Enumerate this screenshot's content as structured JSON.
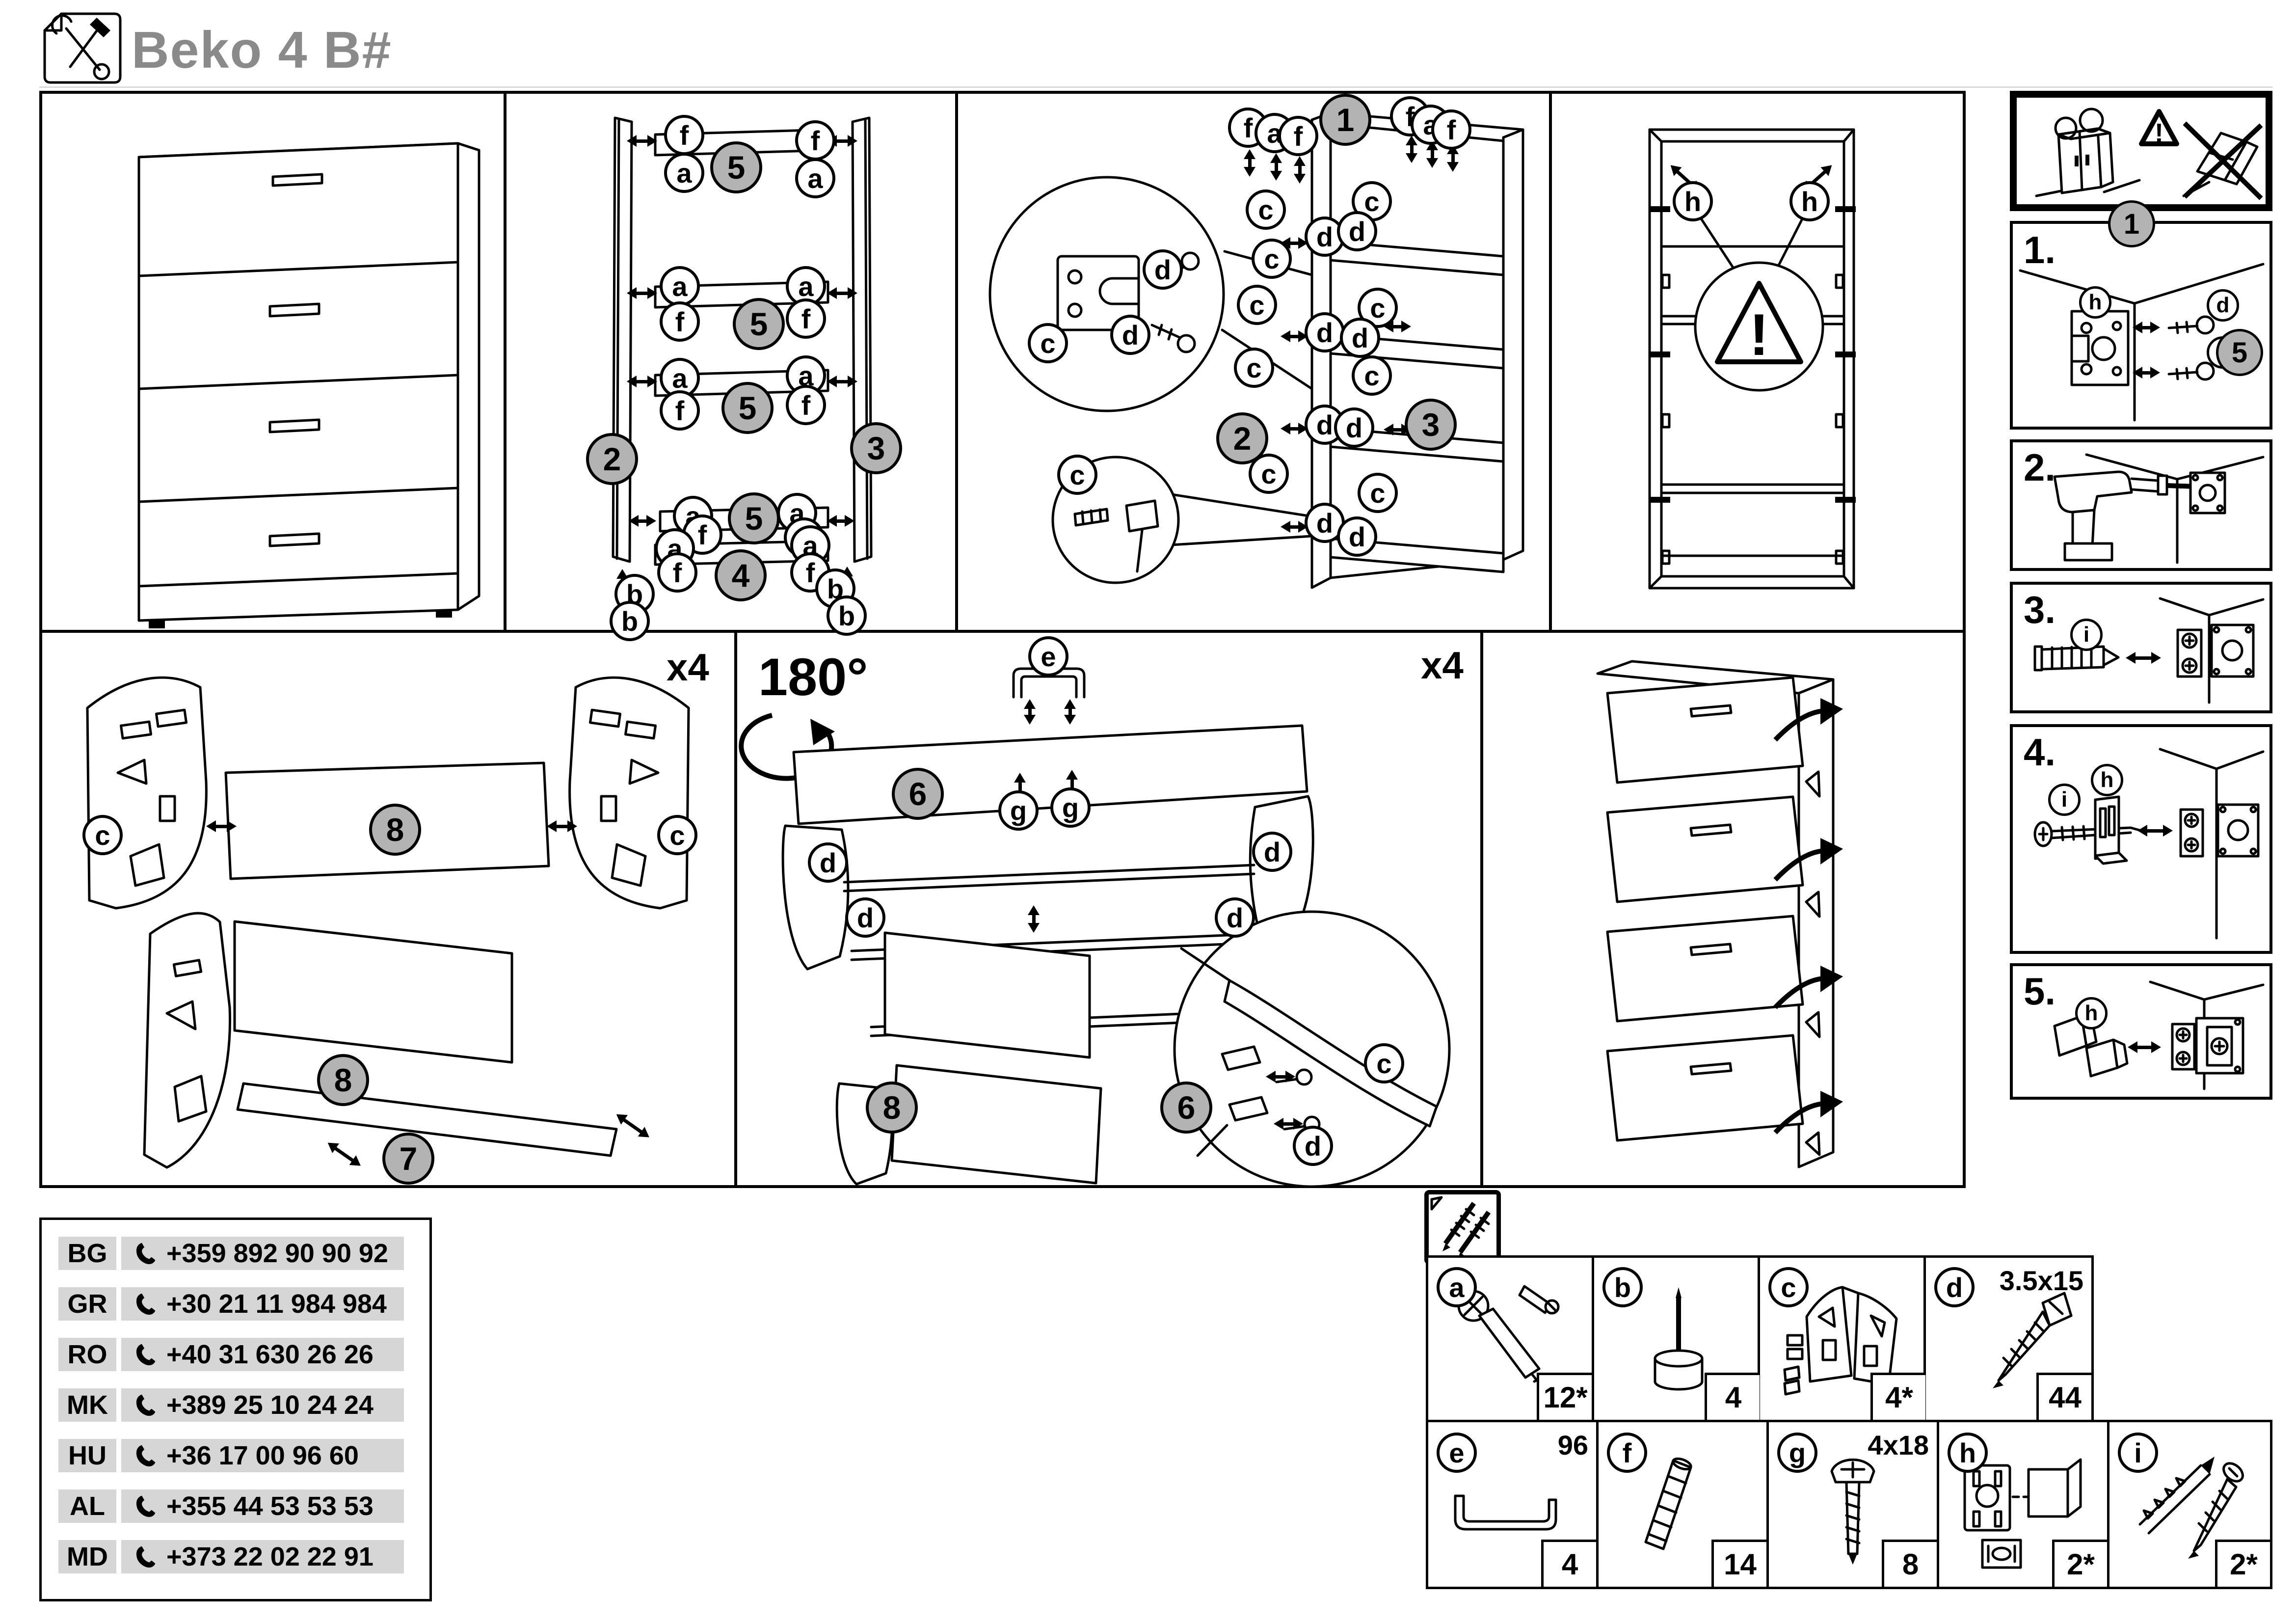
{
  "header": {
    "title": "Beko 4 B#"
  },
  "glyphs": {
    "a": "a",
    "b": "b",
    "c": "c",
    "d": "d",
    "e": "e",
    "f": "f",
    "g": "g",
    "h": "h",
    "i": "i",
    "n1": "1",
    "n2": "2",
    "n3": "3",
    "n4": "4",
    "n5": "5",
    "n6": "6",
    "n7": "7",
    "n8": "8",
    "warn": "!"
  },
  "annotations": {
    "x4": "x4",
    "deg": "180°"
  },
  "steps": {
    "s1": "1.",
    "s2": "2.",
    "s3": "3.",
    "s4": "4.",
    "s5": "5."
  },
  "parts": {
    "a": {
      "label": "a",
      "qty": "12*"
    },
    "b": {
      "label": "b",
      "qty": "4"
    },
    "c": {
      "label": "c",
      "qty": "4*"
    },
    "d": {
      "label": "d",
      "qty": "44",
      "size": "3.5x15"
    },
    "e": {
      "label": "e",
      "qty": "4",
      "size": "96"
    },
    "f": {
      "label": "f",
      "qty": "14"
    },
    "g": {
      "label": "g",
      "qty": "8",
      "size": "4x18"
    },
    "h": {
      "label": "h",
      "qty": "2*"
    },
    "i": {
      "label": "i",
      "qty": "2*"
    }
  },
  "hotline": {
    "rows": [
      {
        "code": "BG",
        "phone": "+359 892 90 90 92"
      },
      {
        "code": "GR",
        "phone": "+30 21 11 984 984"
      },
      {
        "code": "RO",
        "phone": "+40 31 630 26 26"
      },
      {
        "code": "MK",
        "phone": "+389 25 10 24 24"
      },
      {
        "code": "HU",
        "phone": "+36 17 00 96 60"
      },
      {
        "code": "AL",
        "phone": "+355 44 53 53 53"
      },
      {
        "code": "MD",
        "phone": "+373 22 02 22 91"
      }
    ]
  },
  "colors": {
    "line": "#000000",
    "circle_gray": "#b3b3b3",
    "cell_gray": "#d6d6d6",
    "title_gray": "#8a8a8a"
  }
}
